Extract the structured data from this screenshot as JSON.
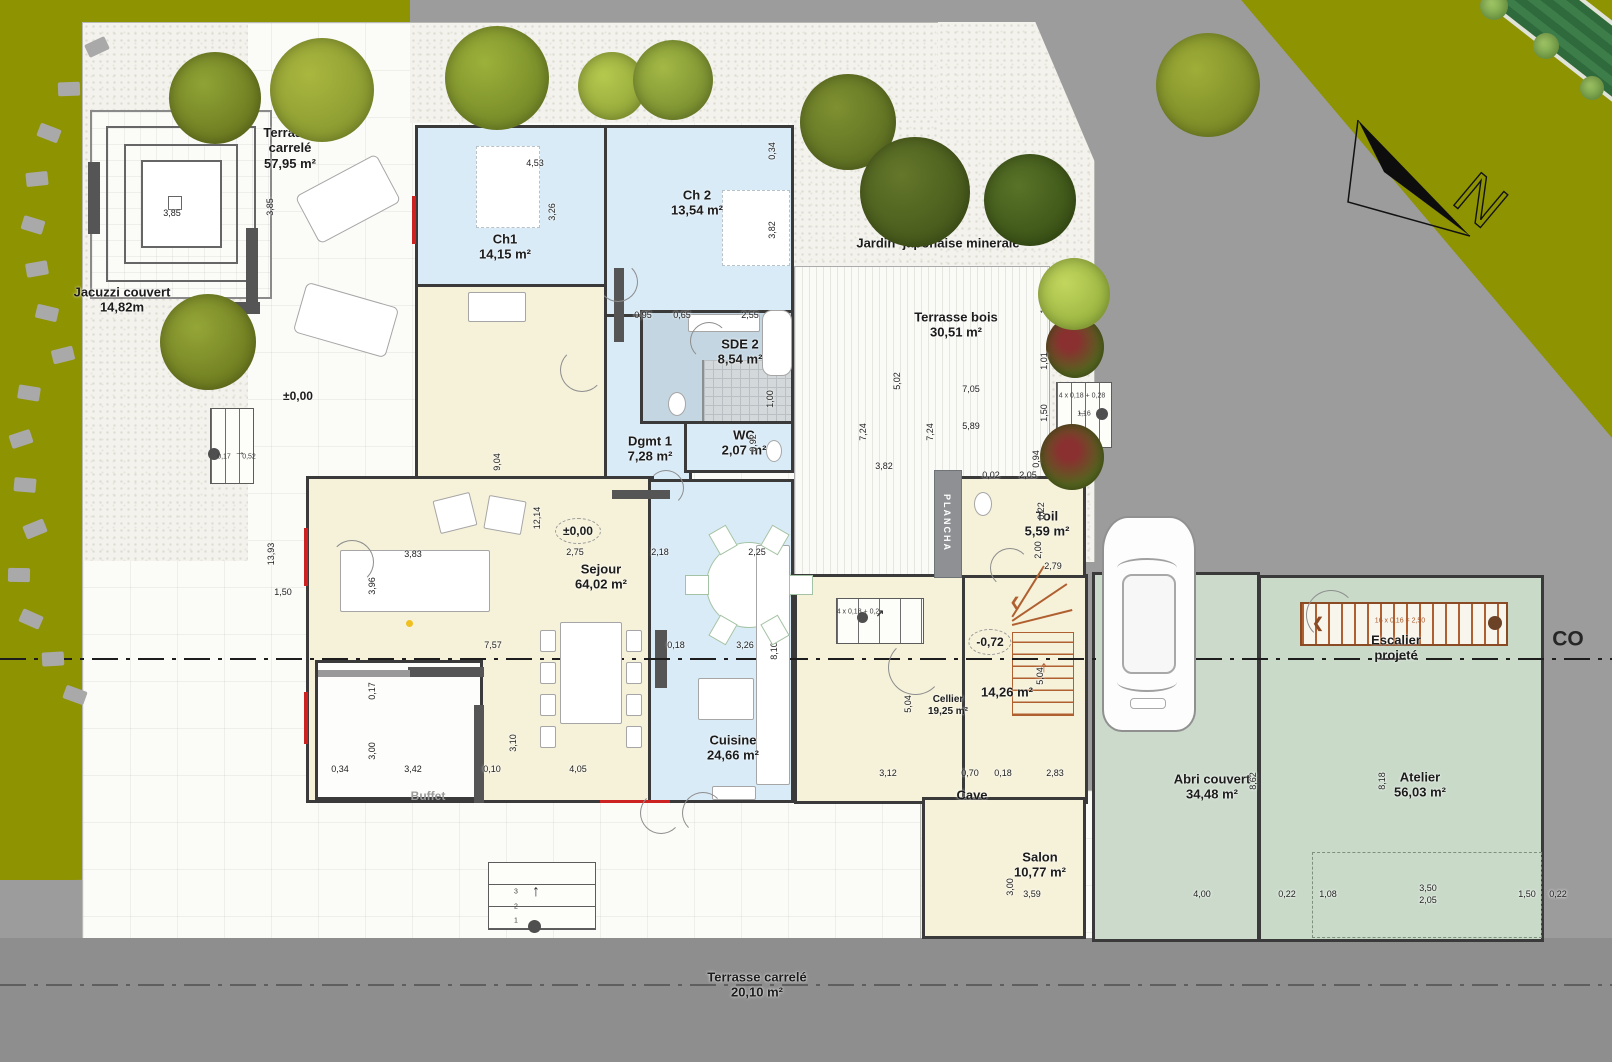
{
  "colors": {
    "lawn": "#8e9302",
    "road": "#9c9c9c",
    "room_blue": "#d9ebf7",
    "room_cream": "#f6f2da",
    "room_green": "#cbdacb",
    "bath_blue": "#c3d6e2",
    "stair_orange": "#a9592b",
    "accent_red": "#cc2222"
  },
  "north": {
    "letter": "N"
  },
  "labels": [
    {
      "id": "terrasse-carrele-nord",
      "lines": [
        "Terrasse",
        "carrelé",
        "57,95 m²"
      ],
      "x": 290,
      "y": 148
    },
    {
      "id": "jacuzzi-couvert",
      "lines": [
        "Jacuzzi couvert",
        "14,82m"
      ],
      "x": 122,
      "y": 300
    },
    {
      "id": "jardin-japonais",
      "lines": [
        "Jardin  japonaise minerale"
      ],
      "x": 938,
      "y": 243
    },
    {
      "id": "terrasse-bois",
      "lines": [
        "Terrasse bois",
        "30,51 m²"
      ],
      "x": 956,
      "y": 325
    },
    {
      "id": "ch1",
      "lines": [
        "Ch1",
        "14,15 m²"
      ],
      "x": 505,
      "y": 247
    },
    {
      "id": "ch2",
      "lines": [
        "Ch 2",
        "13,54 m²"
      ],
      "x": 697,
      "y": 203
    },
    {
      "id": "sde2",
      "lines": [
        "SDE 2",
        "8,54 m²"
      ],
      "x": 740,
      "y": 352
    },
    {
      "id": "dgmt1",
      "lines": [
        "Dgmt 1",
        "7,28 m²"
      ],
      "x": 650,
      "y": 449
    },
    {
      "id": "wc",
      "lines": [
        "WC",
        "2,07 m²"
      ],
      "x": 744,
      "y": 443
    },
    {
      "id": "sejour",
      "lines": [
        "Sejour",
        "64,02 m²"
      ],
      "x": 601,
      "y": 577
    },
    {
      "id": "cuisine",
      "lines": [
        "Cuisine",
        "24,66 m²"
      ],
      "x": 733,
      "y": 748
    },
    {
      "id": "toil",
      "lines": [
        "Toil",
        "5,59 m²"
      ],
      "x": 1047,
      "y": 524
    },
    {
      "id": "cellier",
      "lines": [
        "Cellier",
        "19,25 m²"
      ],
      "x": 948,
      "y": 706,
      "cls": "small"
    },
    {
      "id": "room-1426",
      "lines": [
        "14,26 m²"
      ],
      "x": 1007,
      "y": 692
    },
    {
      "id": "salon",
      "lines": [
        "Salon",
        "10,77 m²"
      ],
      "x": 1040,
      "y": 865
    },
    {
      "id": "abri-couvert",
      "lines": [
        "Abri couvert",
        "34,48 m²"
      ],
      "x": 1212,
      "y": 787
    },
    {
      "id": "atelier",
      "lines": [
        "Atelier",
        "56,03 m²"
      ],
      "x": 1420,
      "y": 785
    },
    {
      "id": "escalier-projete",
      "lines": [
        "Escalier",
        "projeté"
      ],
      "x": 1396,
      "y": 648
    },
    {
      "id": "buffet",
      "lines": [
        "Buffet"
      ],
      "x": 428,
      "y": 796,
      "cls": "muted"
    },
    {
      "id": "cave",
      "lines": [
        "Cave"
      ],
      "x": 972,
      "y": 795
    },
    {
      "id": "terrasse-carrele-sud",
      "lines": [
        "Terrasse carrelé",
        "20,10 m²"
      ],
      "x": 757,
      "y": 985
    },
    {
      "id": "coupe",
      "lines": [
        "CO"
      ],
      "x": 1568,
      "y": 640,
      "cls": "huge"
    }
  ],
  "dimensions": [
    {
      "t": "4,53",
      "x": 535,
      "y": 163
    },
    {
      "t": "3,26",
      "x": 552,
      "y": 212,
      "v": 1
    },
    {
      "t": "0,34",
      "x": 772,
      "y": 151,
      "v": 1
    },
    {
      "t": "3,82",
      "x": 772,
      "y": 230,
      "v": 1
    },
    {
      "t": "3,85",
      "x": 172,
      "y": 213
    },
    {
      "t": "3,85",
      "x": 270,
      "y": 207,
      "v": 1
    },
    {
      "t": "0,95",
      "x": 643,
      "y": 315
    },
    {
      "t": "0,65",
      "x": 682,
      "y": 315
    },
    {
      "t": "2,55",
      "x": 750,
      "y": 315
    },
    {
      "t": "1,00",
      "x": 770,
      "y": 399,
      "v": 1
    },
    {
      "t": "0,92",
      "x": 753,
      "y": 443,
      "v": 1
    },
    {
      "t": "9,04",
      "x": 497,
      "y": 462,
      "v": 1
    },
    {
      "t": "12,14",
      "x": 537,
      "y": 518,
      "v": 1
    },
    {
      "t": "2,75",
      "x": 575,
      "y": 552
    },
    {
      "t": "2,18",
      "x": 660,
      "y": 552
    },
    {
      "t": "2,25",
      "x": 757,
      "y": 552
    },
    {
      "t": "5,02",
      "x": 897,
      "y": 381,
      "v": 1
    },
    {
      "t": "7,05",
      "x": 971,
      "y": 389
    },
    {
      "t": "7,24",
      "x": 863,
      "y": 432,
      "v": 1
    },
    {
      "t": "7,24",
      "x": 930,
      "y": 432,
      "v": 1
    },
    {
      "t": "5,89",
      "x": 971,
      "y": 426
    },
    {
      "t": "3,82",
      "x": 884,
      "y": 466
    },
    {
      "t": "1,50",
      "x": 1044,
      "y": 305,
      "v": 1
    },
    {
      "t": "1,01",
      "x": 1044,
      "y": 361,
      "v": 1
    },
    {
      "t": "1,50",
      "x": 1044,
      "y": 413,
      "v": 1
    },
    {
      "t": "0,94",
      "x": 1036,
      "y": 459,
      "v": 1
    },
    {
      "t": "0,02",
      "x": 991,
      "y": 475
    },
    {
      "t": "2,05",
      "x": 1028,
      "y": 475
    },
    {
      "t": "0,22",
      "x": 1041,
      "y": 511,
      "v": 1
    },
    {
      "t": "2,00",
      "x": 1038,
      "y": 550,
      "v": 1
    },
    {
      "t": "2,79",
      "x": 1053,
      "y": 566
    },
    {
      "t": "13,93",
      "x": 271,
      "y": 554,
      "v": 1
    },
    {
      "t": "1,50",
      "x": 283,
      "y": 592
    },
    {
      "t": "3,83",
      "x": 413,
      "y": 554
    },
    {
      "t": "3,96",
      "x": 372,
      "y": 586,
      "v": 1
    },
    {
      "t": "7,57",
      "x": 493,
      "y": 645
    },
    {
      "t": "0,18",
      "x": 676,
      "y": 645
    },
    {
      "t": "3,26",
      "x": 745,
      "y": 645
    },
    {
      "t": "8,10",
      "x": 774,
      "y": 651,
      "v": 1
    },
    {
      "t": "0,17",
      "x": 372,
      "y": 691,
      "v": 1
    },
    {
      "t": "3,00",
      "x": 372,
      "y": 751,
      "v": 1
    },
    {
      "t": "0,34",
      "x": 340,
      "y": 769
    },
    {
      "t": "3,42",
      "x": 413,
      "y": 769
    },
    {
      "t": "0,10",
      "x": 492,
      "y": 769
    },
    {
      "t": "4,05",
      "x": 578,
      "y": 769
    },
    {
      "t": "3,10",
      "x": 513,
      "y": 743,
      "v": 1
    },
    {
      "t": "5,04",
      "x": 908,
      "y": 704,
      "v": 1
    },
    {
      "t": "5,04",
      "x": 1040,
      "y": 676,
      "v": 1
    },
    {
      "t": "3,12",
      "x": 888,
      "y": 773
    },
    {
      "t": "0,70",
      "x": 970,
      "y": 773
    },
    {
      "t": "0,18",
      "x": 1003,
      "y": 773
    },
    {
      "t": "2,83",
      "x": 1055,
      "y": 773
    },
    {
      "t": "3,00",
      "x": 1010,
      "y": 887,
      "v": 1
    },
    {
      "t": "3,59",
      "x": 1032,
      "y": 894
    },
    {
      "t": "8,62",
      "x": 1253,
      "y": 781,
      "v": 1
    },
    {
      "t": "8,18",
      "x": 1382,
      "y": 781,
      "v": 1
    },
    {
      "t": "4,00",
      "x": 1202,
      "y": 894
    },
    {
      "t": "0,22",
      "x": 1287,
      "y": 894
    },
    {
      "t": "1,08",
      "x": 1328,
      "y": 894
    },
    {
      "t": "3,50",
      "x": 1428,
      "y": 888
    },
    {
      "t": "2,05",
      "x": 1428,
      "y": 900
    },
    {
      "t": "1,50",
      "x": 1527,
      "y": 894
    },
    {
      "t": "0,22",
      "x": 1558,
      "y": 894
    }
  ],
  "notes": [
    {
      "t": "PLANCHA",
      "x": 947,
      "y": 523,
      "cls": "plancha"
    },
    {
      "t": "4 x 0,18 + 0,28",
      "x": 1082,
      "y": 396
    },
    {
      "t": "1,16",
      "x": 1084,
      "y": 414
    },
    {
      "t": "4 x 0,18 + 0,2",
      "x": 858,
      "y": 612
    },
    {
      "t": "16 x 0,16 = 2,50",
      "x": 1400,
      "y": 621,
      "cls": "tiny-orange"
    },
    {
      "t": "0,17",
      "x": 224,
      "y": 457
    },
    {
      "t": "0,52",
      "x": 249,
      "y": 457
    },
    {
      "t": "3",
      "x": 516,
      "y": 892
    },
    {
      "t": "2",
      "x": 516,
      "y": 907
    },
    {
      "t": "1",
      "x": 516,
      "y": 921
    }
  ],
  "elevations": [
    {
      "t": "±0,00",
      "x": 298,
      "y": 396
    },
    {
      "t": "±0,00",
      "x": 578,
      "y": 531,
      "circle": 1
    },
    {
      "t": "-0,72",
      "x": 990,
      "y": 642,
      "circle": 1
    }
  ]
}
